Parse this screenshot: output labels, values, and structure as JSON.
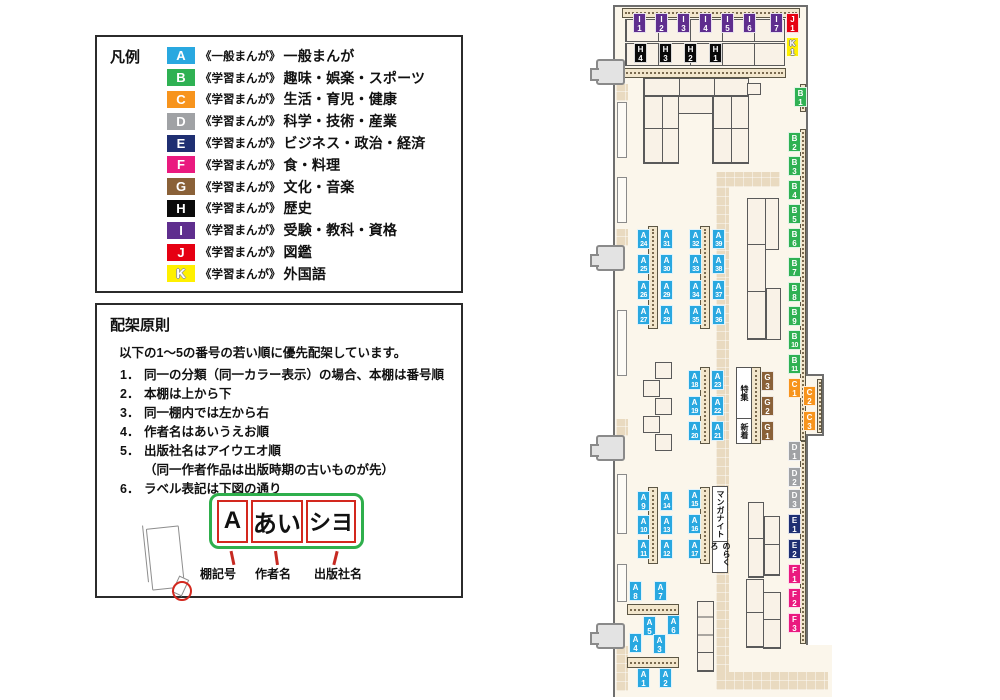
{
  "legend": {
    "title": "凡例",
    "items": [
      {
        "code": "A",
        "series": "《一般まんが》",
        "label": "一般まんが"
      },
      {
        "code": "B",
        "series": "《学習まんが》",
        "label": "趣味・娯楽・スポーツ"
      },
      {
        "code": "C",
        "series": "《学習まんが》",
        "label": "生活・育児・健康"
      },
      {
        "code": "D",
        "series": "《学習まんが》",
        "label": "科学・技術・産業"
      },
      {
        "code": "E",
        "series": "《学習まんが》",
        "label": "ビジネス・政治・経済"
      },
      {
        "code": "F",
        "series": "《学習まんが》",
        "label": "食・料理"
      },
      {
        "code": "G",
        "series": "《学習まんが》",
        "label": "文化・音楽"
      },
      {
        "code": "H",
        "series": "《学習まんが》",
        "label": "歴史"
      },
      {
        "code": "I",
        "series": "《学習まんが》",
        "label": "受験・教科・資格"
      },
      {
        "code": "J",
        "series": "《学習まんが》",
        "label": "図鑑"
      },
      {
        "code": "K",
        "series": "《学習まんが》",
        "label": "外国語"
      }
    ]
  },
  "principles": {
    "title": "配架原則",
    "intro": "以下の1～5の番号の若い順に優先配架しています。",
    "items": [
      {
        "num": "1．",
        "text": "同一の分類（同一カラー表示）の場合、本棚は番号順"
      },
      {
        "num": "2．",
        "text": "本棚は上から下"
      },
      {
        "num": "3．",
        "text": "同一棚内では左から右"
      },
      {
        "num": "4．",
        "text": "作者名はあいうえお順"
      },
      {
        "num": "5．",
        "text": "出版社名はアイウエオ順",
        "sub": "（同一作者作品は出版時期の古いものが先）"
      },
      {
        "num": "6．",
        "text": "ラベル表記は下図の通り"
      }
    ],
    "label_example": {
      "cells": [
        "A",
        "あい",
        "シヨ"
      ],
      "callouts": [
        "棚記号",
        "作者名",
        "出版社名"
      ]
    }
  },
  "map": {
    "category_colors": {
      "A": "#29A8E0",
      "B": "#2FB153",
      "C": "#F7941D",
      "D": "#A0A2A5",
      "E": "#1F2F72",
      "F": "#EA1A7F",
      "G": "#8A6138",
      "H": "#0A0A0A",
      "I": "#5F2E8E",
      "J": "#E60012",
      "K": "#FFF000"
    },
    "labels": [
      {
        "id": "I1",
        "x": 633,
        "y": 13
      },
      {
        "id": "I2",
        "x": 655,
        "y": 13
      },
      {
        "id": "I3",
        "x": 677,
        "y": 13
      },
      {
        "id": "I4",
        "x": 699,
        "y": 13
      },
      {
        "id": "I5",
        "x": 721,
        "y": 13
      },
      {
        "id": "I6",
        "x": 743,
        "y": 13
      },
      {
        "id": "I7",
        "x": 770,
        "y": 13
      },
      {
        "id": "J1",
        "x": 786,
        "y": 13
      },
      {
        "id": "K1",
        "x": 786,
        "y": 37
      },
      {
        "id": "H4",
        "x": 634,
        "y": 43
      },
      {
        "id": "H3",
        "x": 659,
        "y": 43
      },
      {
        "id": "H2",
        "x": 684,
        "y": 43
      },
      {
        "id": "H1",
        "x": 709,
        "y": 43
      },
      {
        "id": "B1",
        "x": 794,
        "y": 87
      },
      {
        "id": "B2",
        "x": 788,
        "y": 132
      },
      {
        "id": "B3",
        "x": 788,
        "y": 156
      },
      {
        "id": "B4",
        "x": 788,
        "y": 180
      },
      {
        "id": "B5",
        "x": 788,
        "y": 204
      },
      {
        "id": "B6",
        "x": 788,
        "y": 228
      },
      {
        "id": "B7",
        "x": 788,
        "y": 257
      },
      {
        "id": "B8",
        "x": 788,
        "y": 282
      },
      {
        "id": "B9",
        "x": 788,
        "y": 306
      },
      {
        "id": "B10",
        "x": 788,
        "y": 330
      },
      {
        "id": "B11",
        "x": 788,
        "y": 354
      },
      {
        "id": "C1",
        "x": 788,
        "y": 378
      },
      {
        "id": "C2",
        "x": 803,
        "y": 386
      },
      {
        "id": "C3",
        "x": 803,
        "y": 411
      },
      {
        "id": "D1",
        "x": 788,
        "y": 441
      },
      {
        "id": "D2",
        "x": 788,
        "y": 467
      },
      {
        "id": "D3",
        "x": 788,
        "y": 489
      },
      {
        "id": "E1",
        "x": 788,
        "y": 514
      },
      {
        "id": "E2",
        "x": 788,
        "y": 539
      },
      {
        "id": "F1",
        "x": 788,
        "y": 564
      },
      {
        "id": "F2",
        "x": 788,
        "y": 588
      },
      {
        "id": "F3",
        "x": 788,
        "y": 613
      },
      {
        "id": "G3",
        "x": 761,
        "y": 371
      },
      {
        "id": "G2",
        "x": 761,
        "y": 396
      },
      {
        "id": "G1",
        "x": 761,
        "y": 421
      },
      {
        "id": "A24",
        "x": 637,
        "y": 229
      },
      {
        "id": "A25",
        "x": 637,
        "y": 254
      },
      {
        "id": "A26",
        "x": 637,
        "y": 280
      },
      {
        "id": "A27",
        "x": 637,
        "y": 305
      },
      {
        "id": "A31",
        "x": 660,
        "y": 229
      },
      {
        "id": "A30",
        "x": 660,
        "y": 254
      },
      {
        "id": "A29",
        "x": 660,
        "y": 280
      },
      {
        "id": "A28",
        "x": 660,
        "y": 305
      },
      {
        "id": "A32",
        "x": 689,
        "y": 229
      },
      {
        "id": "A33",
        "x": 689,
        "y": 254
      },
      {
        "id": "A34",
        "x": 689,
        "y": 280
      },
      {
        "id": "A35",
        "x": 689,
        "y": 305
      },
      {
        "id": "A39",
        "x": 712,
        "y": 229
      },
      {
        "id": "A38",
        "x": 712,
        "y": 254
      },
      {
        "id": "A37",
        "x": 712,
        "y": 280
      },
      {
        "id": "A36",
        "x": 712,
        "y": 305
      },
      {
        "id": "A18",
        "x": 688,
        "y": 370
      },
      {
        "id": "A19",
        "x": 688,
        "y": 396
      },
      {
        "id": "A20",
        "x": 688,
        "y": 421
      },
      {
        "id": "A23",
        "x": 711,
        "y": 370
      },
      {
        "id": "A22",
        "x": 711,
        "y": 396
      },
      {
        "id": "A21",
        "x": 711,
        "y": 421
      },
      {
        "id": "A9",
        "x": 637,
        "y": 491
      },
      {
        "id": "A10",
        "x": 637,
        "y": 515
      },
      {
        "id": "A11",
        "x": 637,
        "y": 539
      },
      {
        "id": "A14",
        "x": 660,
        "y": 491
      },
      {
        "id": "A13",
        "x": 660,
        "y": 515
      },
      {
        "id": "A12",
        "x": 660,
        "y": 539
      },
      {
        "id": "A15",
        "x": 688,
        "y": 489
      },
      {
        "id": "A16",
        "x": 688,
        "y": 514
      },
      {
        "id": "A17",
        "x": 688,
        "y": 539
      },
      {
        "id": "A8",
        "x": 629,
        "y": 581
      },
      {
        "id": "A7",
        "x": 654,
        "y": 581
      },
      {
        "id": "A5",
        "x": 643,
        "y": 616
      },
      {
        "id": "A6",
        "x": 667,
        "y": 615
      },
      {
        "id": "A4",
        "x": 629,
        "y": 633
      },
      {
        "id": "A3",
        "x": 653,
        "y": 634
      },
      {
        "id": "A1",
        "x": 637,
        "y": 668
      },
      {
        "id": "A2",
        "x": 659,
        "y": 668
      }
    ],
    "areas": [
      {
        "id": "tokushu",
        "text": "特集",
        "x": 736,
        "y": 367,
        "w": 14,
        "h": 50
      },
      {
        "id": "shinchaku",
        "text": "新着",
        "x": 736,
        "y": 418,
        "w": 14,
        "h": 24
      },
      {
        "id": "manga-night",
        "text": "マンガナイト",
        "x": 712,
        "y": 486,
        "w": 14,
        "h": 54
      },
      {
        "id": "norakuro",
        "text": "のらくろ",
        "x": 712,
        "y": 541,
        "w": 14,
        "h": 30
      }
    ]
  }
}
